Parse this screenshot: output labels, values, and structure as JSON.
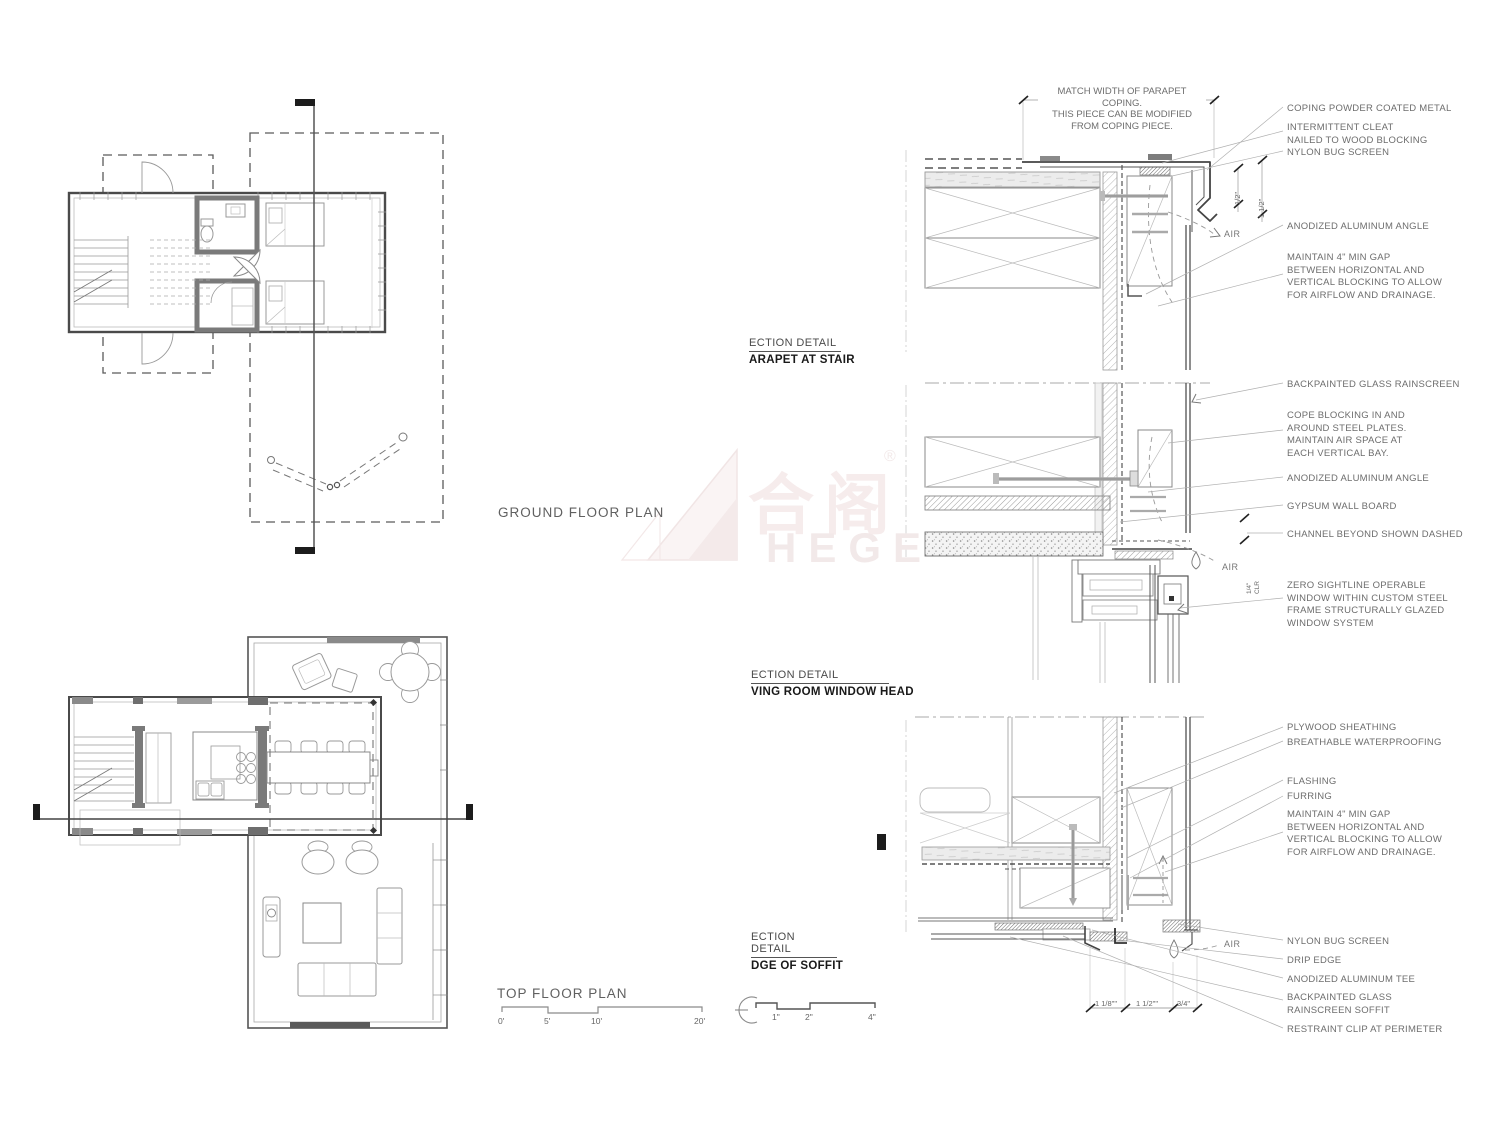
{
  "plan_labels": {
    "ground": "GROUND FLOOR PLAN",
    "top": "TOP FLOOR PLAN"
  },
  "section_titles": {
    "parapet": {
      "line1": "ECTION DETAIL",
      "line2": "ARAPET AT STAIR"
    },
    "window_head": {
      "line1": "ECTION DETAIL",
      "line2": "VING ROOM WINDOW HEAD"
    },
    "soffit": {
      "line1": "ECTION DETAIL",
      "line2": "DGE OF SOFFIT"
    }
  },
  "note": {
    "text": "MATCH WIDTH OF PARAPET COPING.\nTHIS PIECE CAN BE MODIFIED\nFROM COPING PIECE."
  },
  "annotations": {
    "parapet": [
      "COPING POWDER COATED METAL",
      "INTERMITTENT CLEAT\nNAILED TO WOOD BLOCKING",
      "NYLON BUG SCREEN",
      "ANODIZED ALUMINUM ANGLE",
      "MAINTAIN 4\" MIN GAP\nBETWEEN HORIZONTAL AND\nVERTICAL BLOCKING TO ALLOW\nFOR AIRFLOW AND DRAINAGE."
    ],
    "window_head": [
      "BACKPAINTED GLASS RAINSCREEN",
      "COPE BLOCKING IN AND\nAROUND STEEL PLATES.\nMAINTAIN AIR SPACE AT\nEACH VERTICAL BAY.",
      "ANODIZED ALUMINUM ANGLE",
      "GYPSUM WALL BOARD",
      "CHANNEL BEYOND SHOWN DASHED",
      "ZERO SIGHTLINE OPERABLE\nWINDOW WITHIN CUSTOM STEEL\nFRAME STRUCTURALLY GLAZED\nWINDOW SYSTEM"
    ],
    "soffit": [
      "PLYWOOD SHEATHING",
      "BREATHABLE WATERPROOFING",
      "FLASHING",
      "FURRING",
      "MAINTAIN 4\" MIN GAP\nBETWEEN HORIZONTAL AND\nVERTICAL BLOCKING TO ALLOW\nFOR AIRFLOW AND DRAINAGE.",
      "NYLON BUG SCREEN",
      "DRIP EDGE",
      "ANODIZED ALUMINUM TEE",
      "BACKPAINTED GLASS\nRAINSCREEN SOFFIT",
      "RESTRAINT CLIP AT PERIMETER"
    ]
  },
  "dims": {
    "half_inch": "1/2\"",
    "one_and_half_inch": "1 1/2\"",
    "quarter_clear": "1/4\"\nCLR",
    "air": "AIR",
    "soffit_dims": [
      "1 1/8\"\"",
      "1 1/2\"\"",
      "3/4\""
    ]
  },
  "scales": {
    "feet": [
      "0'",
      "5'",
      "10'",
      "20'"
    ],
    "inches": [
      "1\"",
      "2\"",
      "4\""
    ]
  },
  "watermark": {
    "cjk": "合阁",
    "latin": "HEGE",
    "reg": "®"
  }
}
